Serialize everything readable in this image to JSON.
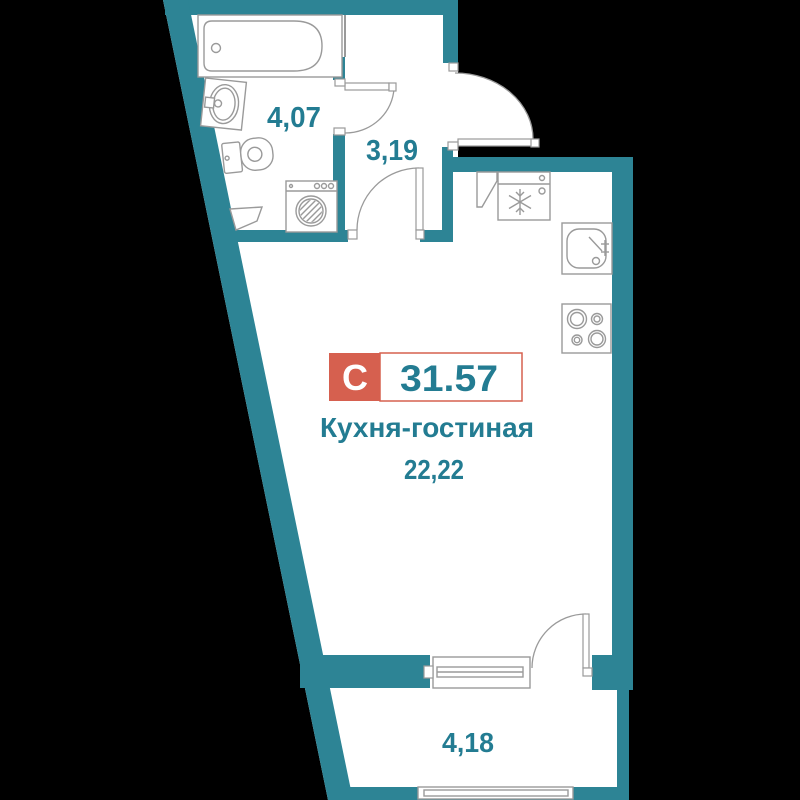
{
  "floorplan": {
    "unit": {
      "type_label": "С",
      "total_area": "31.57"
    },
    "rooms": {
      "bathroom": {
        "area": "4,07"
      },
      "hallway": {
        "area": "3,19"
      },
      "kitchen_living": {
        "name": "Кухня-гостиная",
        "area": "22,22"
      },
      "balcony": {
        "area": "4,18"
      }
    },
    "colors": {
      "wall_teal": "#2d8495",
      "label_teal": "#237c92",
      "badge_red": "#d6604f",
      "line_gray": "#9a9a9a",
      "background": "#000000",
      "floor": "#ffffff"
    },
    "icons": {
      "snowflake-icon": "fridge freezer mark (✻ line star)",
      "bathtub-icon": "rounded tub outline",
      "sink-icon": "oval basin with faucet",
      "toilet-icon": "tank + bowl outline",
      "washing-machine-icon": "drum circle with diagonal hatch",
      "stove-icon": "four burner rings",
      "kitchen-sink-icon": "rounded square basin with faucet",
      "door-arc-icon": "quarter-circle swing",
      "window-icon": "double-line sill band"
    }
  }
}
